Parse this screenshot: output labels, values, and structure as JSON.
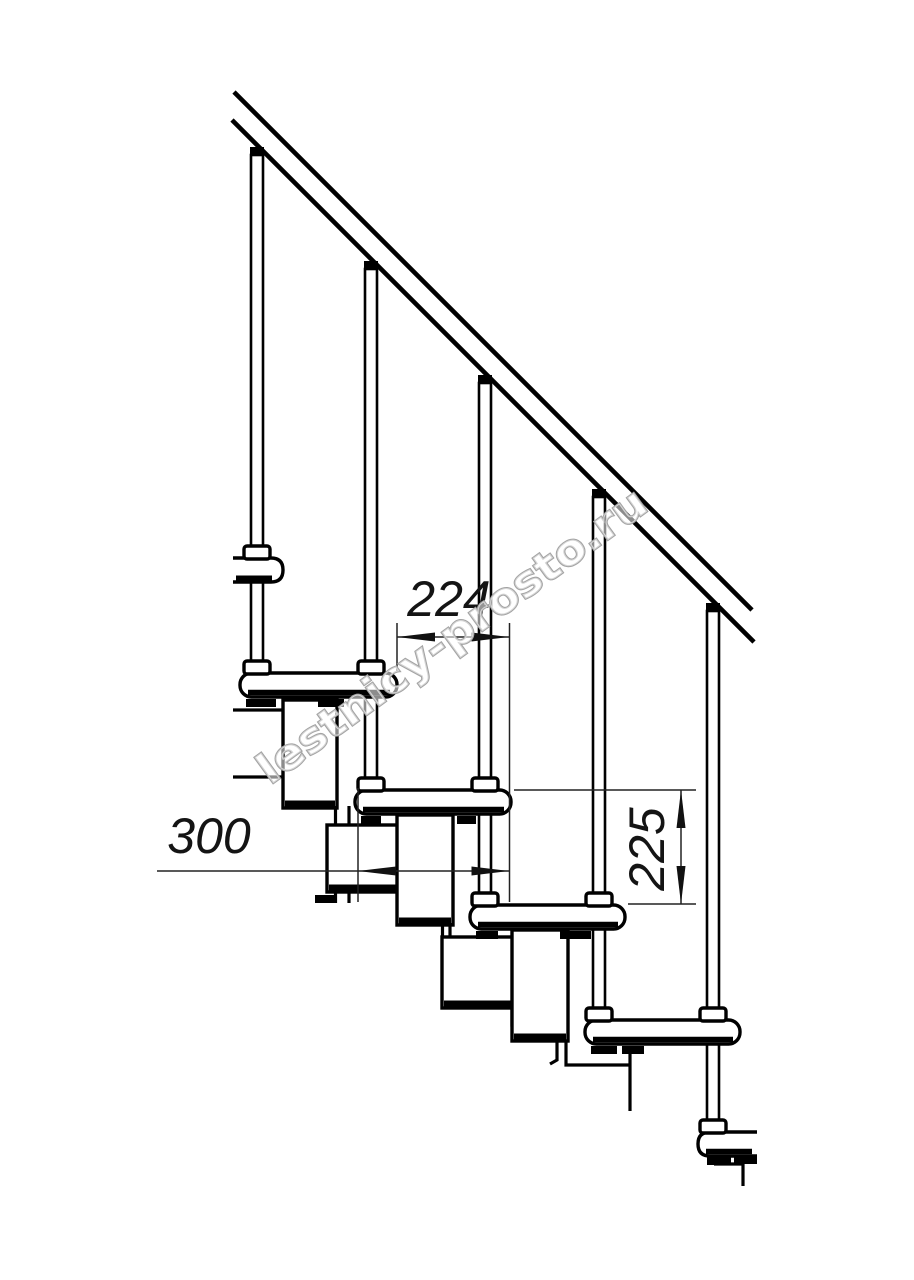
{
  "drawing": {
    "title": "modular-staircase-side-view",
    "watermark_text": "lestnicy-prosto.ru",
    "colors": {
      "line": "#000000",
      "dimension": "#141414",
      "watermark_outline": "#a3a3a3",
      "background": "#ffffff"
    },
    "dimensions": [
      {
        "id": "step-going",
        "label": "224",
        "orientation": "horizontal"
      },
      {
        "id": "tread-depth",
        "label": "300",
        "orientation": "horizontal"
      },
      {
        "id": "riser-height",
        "label": "225",
        "orientation": "vertical"
      }
    ],
    "structure": {
      "treads_visible": 6,
      "balusters_visible": 5,
      "handrail": "diagonal-double-line"
    }
  }
}
